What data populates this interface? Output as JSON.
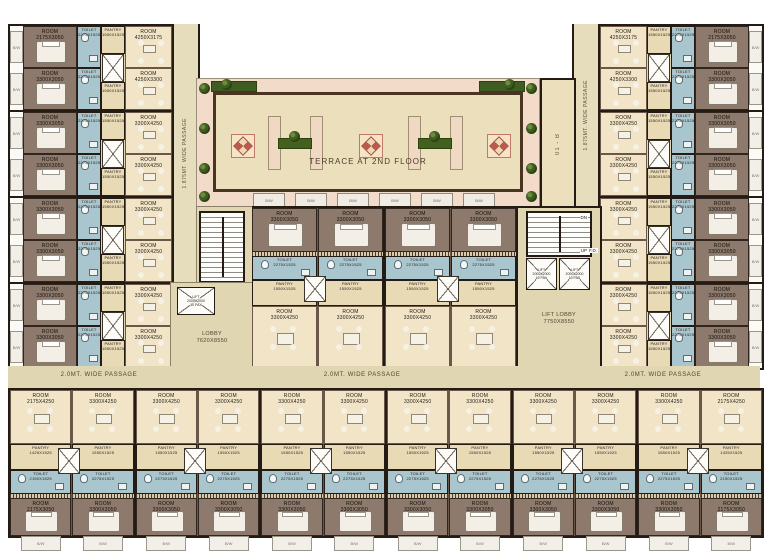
{
  "labels": {
    "terrace": "TERRACE AT 2ND FLOOR",
    "annex": "01 - B",
    "passage_vertical": "1.875MT. WIDE PASSAGE",
    "passage_horizontal": "2.0MT. WIDE PASSAGE",
    "balcony": "B/W",
    "up": "UP",
    "dn": "DN",
    "fd": "F.D."
  },
  "colors": {
    "field": "#e0d6b2",
    "tan_room": "#f1e4c7",
    "brown_room": "#8d7a6c",
    "toilet_blue": "#a9c6cf",
    "wall": "#241c14",
    "terrace_band": "#f2dcc9",
    "terrace_floor": "#ece0bc",
    "planter_green": "#3f5c23",
    "medallion_red": "#b85a4c"
  },
  "core": {
    "lobby_title": "LOBBY",
    "lobby_dim": "7620X8550",
    "lift_lobby_title": "LIFT LOBBY",
    "lift_lobby_dim": "7750X8550",
    "lift_title": "LIFT",
    "lift_dim": "2000X2000",
    "lift_cap": "10 PAX"
  },
  "room_types": {
    "room_std": {
      "t": "ROOM",
      "d": "3300X3050"
    },
    "room_deep": {
      "t": "ROOM",
      "d": "3300X4250"
    },
    "room_end": {
      "t": "ROOM",
      "d": "2175X3050"
    },
    "room_end_deep": {
      "t": "ROOM",
      "d": "2175X4250"
    },
    "room_top_a": {
      "t": "ROOM",
      "d": "4250X3175"
    },
    "room_top_b": {
      "t": "ROOM",
      "d": "4250X3300"
    },
    "toilet": {
      "t": "TOILET",
      "d": "2275X1525"
    },
    "toilet_end": {
      "t": "TOILET",
      "d": "2150X1525"
    },
    "pantry": {
      "t": "PANTRY",
      "d": "1550X1525"
    },
    "pantry_end": {
      "t": "PANTRY",
      "d": "1425X1525"
    }
  },
  "left_wing": {
    "modules": [
      {
        "tan": [
          "room_top_a",
          "room_top_b"
        ],
        "brown": [
          "room_end",
          "room_std"
        ],
        "toilet": "toilet",
        "pantry": "pantry"
      },
      {
        "tan": [
          "room_deep",
          "room_deep"
        ],
        "brown": [
          "room_std",
          "room_std"
        ],
        "toilet": "toilet",
        "pantry": "pantry"
      },
      {
        "tan": [
          "room_deep",
          "room_deep"
        ],
        "brown": [
          "room_std",
          "room_std"
        ],
        "toilet": "toilet",
        "pantry": "pantry"
      },
      {
        "tan": [
          "room_deep",
          "room_deep"
        ],
        "brown": [
          "room_std",
          "room_std"
        ],
        "toilet": "toilet",
        "pantry": "pantry"
      }
    ]
  },
  "right_wing": {
    "modules": [
      {
        "tan": [
          "room_top_a",
          "room_top_b"
        ],
        "brown": [
          "room_end",
          "room_std"
        ],
        "toilet": "toilet",
        "pantry": "pantry"
      },
      {
        "tan": [
          "room_deep",
          "room_deep"
        ],
        "brown": [
          "room_std",
          "room_std"
        ],
        "toilet": "toilet",
        "pantry": "pantry"
      },
      {
        "tan": [
          "room_deep",
          "room_deep"
        ],
        "brown": [
          "room_std",
          "room_std"
        ],
        "toilet": "toilet",
        "pantry": "pantry"
      },
      {
        "tan": [
          "room_deep",
          "room_deep"
        ],
        "brown": [
          "room_std",
          "room_std"
        ],
        "toilet": "toilet",
        "pantry": "pantry"
      }
    ]
  },
  "center_block": {
    "units": [
      {
        "top": "room_std",
        "toilet": "toilet",
        "pantry": "pantry",
        "bottom": "room_deep"
      },
      {
        "top": "room_std",
        "toilet": "toilet",
        "pantry": "pantry",
        "bottom": "room_deep"
      },
      {
        "top": "room_std",
        "toilet": "toilet",
        "pantry": "pantry",
        "bottom": "room_deep"
      },
      {
        "top": "room_std",
        "toilet": "toilet",
        "pantry": "pantry",
        "bottom": "room_deep"
      }
    ],
    "terrace_balcony_count": 6
  },
  "bottom_block": {
    "units": [
      {
        "top": "room_end_deep",
        "pantry": "pantry_end",
        "toilet": "toilet_end",
        "bottom": "room_end"
      },
      {
        "top": "room_deep",
        "pantry": "pantry",
        "toilet": "toilet",
        "bottom": "room_std"
      },
      {
        "top": "room_deep",
        "pantry": "pantry",
        "toilet": "toilet",
        "bottom": "room_std"
      },
      {
        "top": "room_deep",
        "pantry": "pantry",
        "toilet": "toilet",
        "bottom": "room_std"
      },
      {
        "top": "room_deep",
        "pantry": "pantry",
        "toilet": "toilet",
        "bottom": "room_std"
      },
      {
        "top": "room_deep",
        "pantry": "pantry",
        "toilet": "toilet",
        "bottom": "room_std"
      },
      {
        "top": "room_deep",
        "pantry": "pantry",
        "toilet": "toilet",
        "bottom": "room_std"
      },
      {
        "top": "room_deep",
        "pantry": "pantry",
        "toilet": "toilet",
        "bottom": "room_std"
      },
      {
        "top": "room_deep",
        "pantry": "pantry",
        "toilet": "toilet",
        "bottom": "room_std"
      },
      {
        "top": "room_deep",
        "pantry": "pantry",
        "toilet": "toilet",
        "bottom": "room_std"
      },
      {
        "top": "room_deep",
        "pantry": "pantry",
        "toilet": "toilet",
        "bottom": "room_std"
      },
      {
        "top": "room_end_deep",
        "pantry": "pantry_end",
        "toilet": "toilet_end",
        "bottom": "room_end"
      }
    ]
  }
}
